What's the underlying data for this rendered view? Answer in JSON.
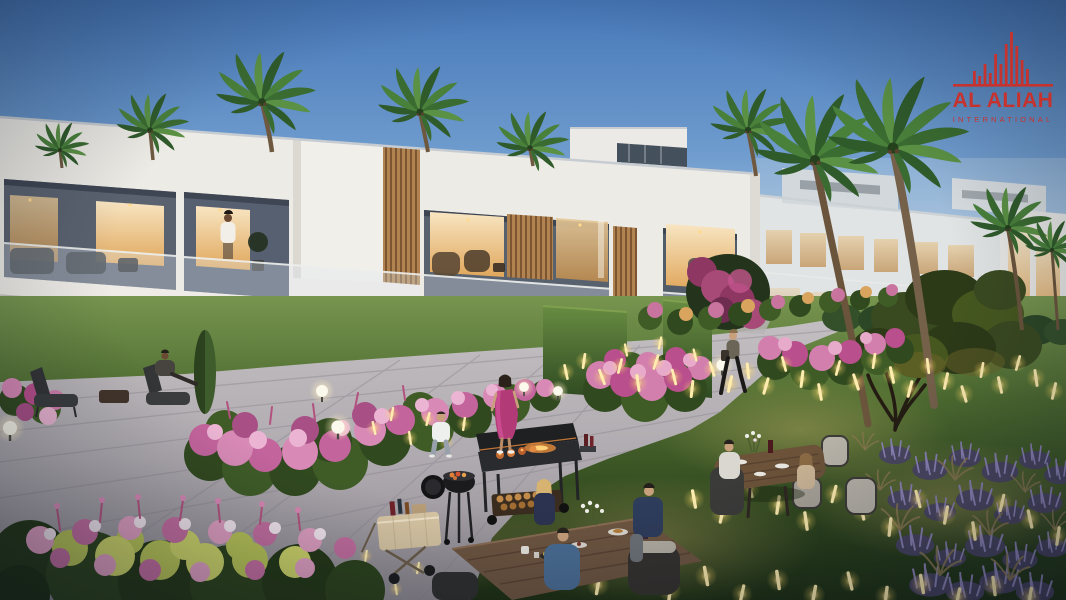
{
  "logo": {
    "title": "AL ALIAH",
    "subtitle": "INTERNATIONAL",
    "brand_color": "#C6332E",
    "icon": "skyline-bars-icon"
  },
  "scene": {
    "type": "architectural dusk rendering",
    "subject": "Modern two-storey white townhouse community with a landscaped communal garden at dusk",
    "buildings": {
      "style": "contemporary white villas",
      "floors": "2",
      "features": [
        "flat roof parapets",
        "recessed balconies with glass balustrades",
        "timber slat screens",
        "floor-to-ceiling glazing",
        "warm lit interiors",
        "rooftop volume with clerestory glazing"
      ]
    },
    "landscape": [
      "palm trees",
      "ornamental tree",
      "stone paved promenade",
      "stepping stones",
      "pink flower beds",
      "lavender and ornamental grasses",
      "clipped hedges",
      "lawn"
    ],
    "lighting": [
      "clear dusk sky",
      "globe path lamps",
      "glowing stick lights among planting"
    ],
    "people": [
      "man standing on balcony",
      "person reading on ground-floor patio",
      "couple strolling on the path",
      "woman in magenta dress",
      "resident walking with a bag",
      "two people seated at a round garden table",
      "three people dining at a wooden picnic table",
      "tiny figure on distant balcony"
    ],
    "objects": [
      "kettle barbecue",
      "flat-top barbecue cart with firewood",
      "serving trolley with drinks",
      "wicker dining chairs",
      "flower vase",
      "plates of food"
    ]
  },
  "colors": {
    "sky_top": "#4677B8",
    "sky_horizon": "#DCDCD4",
    "facade": "#EDEBE5",
    "window_warm": "#F3CE93",
    "timber": "#B08350",
    "lawn": "#4E6C30",
    "path": "#AFAAAF",
    "flower_pink": "#D889B6",
    "flower_magenta": "#A84F86",
    "lavender": "#5C5480",
    "fairy_light": "#FFEDB0",
    "hedge": "#2F4A22",
    "brand_red": "#C6332E"
  }
}
